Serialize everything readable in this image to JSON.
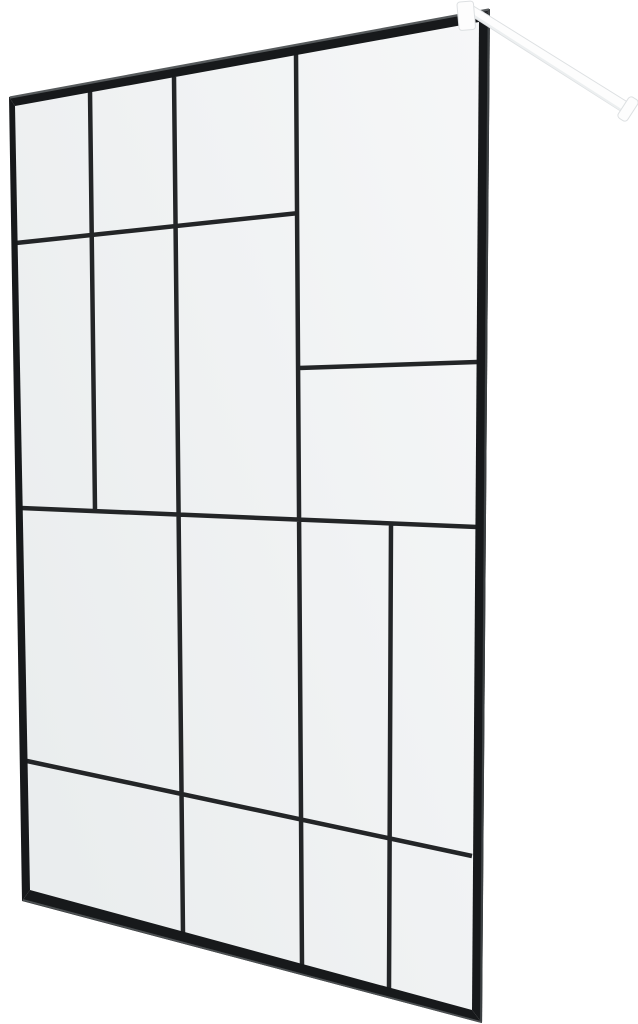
{
  "page": {
    "background": "#ffffff"
  },
  "product": {
    "name": "walk-in-shower-screen",
    "alt": "Walk-in shower glass screen with black frame, abstract black grid pattern and white wall support arm"
  },
  "colors": {
    "bg": "#ffffff",
    "frame": "#17191b",
    "grid": "#232527",
    "glass_dark": "#eaedee",
    "glass_mid": "#f0f2f3",
    "glass_light": "#f6f7f8",
    "edge_top": "#565a5c",
    "edge_right": "#3d4143",
    "edge_bottom": "#4c5052",
    "arm_fill": "#fdfdfd",
    "arm_stroke": "#dde0e2",
    "arm_shade": "#eceff0"
  },
  "panel": {
    "glass_path": "M12,101 L486,14 L478,1016 L27,892 Z",
    "frame_top": "M9,97 L490,9 L479,22 L15,106 Z",
    "frame_right": "M490,9 L482,1023 L472,1010 L479,22 Z",
    "frame_bottom": "M482,1023 L22,901 L30,890 L472,1010 Z",
    "frame_left": "M9,97 L15,106 L30,890 L22,901 Z",
    "grid_path": "M90,91 L95,510 M174,77 L183,934 M296,54 L302,965 M391,524 L389,988 M16,243 L299,213 M299,368 L477,362 M21,508 L477,527 M27,761 L472,856",
    "edge_top_path": "M10,97.5 L489,9.5",
    "edge_right_path": "M488.8,10 L481,1022",
    "edge_bottom_path": "M481,1022 L23,900"
  },
  "arm": {
    "bar_path": "M471,4.5 L631.5,104.5 L624.5,113.5 L470,15 Z",
    "bar_shade_path": "M470.5,13.5 L625,112.5",
    "clamp": {
      "x": "458",
      "y": "1.5",
      "w": "16.5",
      "h": "28.5",
      "rx": "3",
      "transform": "rotate(-5 466 16)"
    },
    "cap": {
      "x": "622.5",
      "y": "96.5",
      "w": "11",
      "h": "25",
      "rx": "3.5",
      "transform": "rotate(33 628 109)"
    }
  }
}
